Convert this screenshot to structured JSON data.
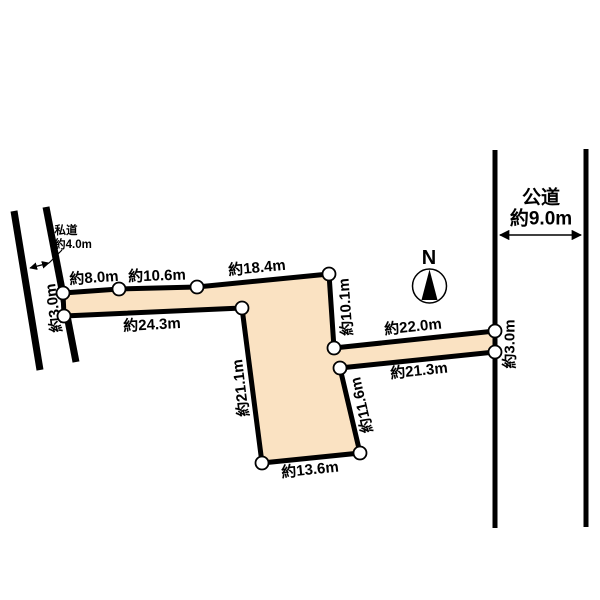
{
  "diagram": {
    "background": "#ffffff",
    "parcel_fill": "#fae2c2",
    "line_color": "#000000"
  },
  "compass": {
    "north_label": "N"
  },
  "roads": {
    "public": {
      "name": "公道",
      "width": "約9.0m"
    },
    "private": {
      "name": "私道",
      "width": "約4.0m"
    }
  },
  "dimensions": [
    {
      "id": "top-1",
      "text": "約8.0m"
    },
    {
      "id": "top-2",
      "text": "約10.6m"
    },
    {
      "id": "top-3",
      "text": "約18.4m"
    },
    {
      "id": "left-arm-bottom",
      "text": "約24.3m"
    },
    {
      "id": "left-frontage",
      "text": "約3.0m"
    },
    {
      "id": "upper-right-side",
      "text": "約10.1m"
    },
    {
      "id": "right-arm-top",
      "text": "約22.0m"
    },
    {
      "id": "right-arm-bottom",
      "text": "約21.3m"
    },
    {
      "id": "right-frontage",
      "text": "約3.0m"
    },
    {
      "id": "body-left-side",
      "text": "約21.1m"
    },
    {
      "id": "body-right-side",
      "text": "約11.6m"
    },
    {
      "id": "bottom",
      "text": "約13.6m"
    }
  ]
}
